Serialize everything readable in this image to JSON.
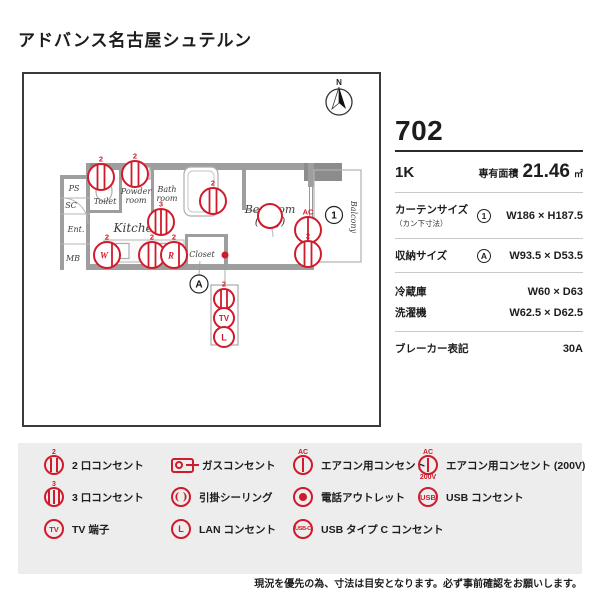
{
  "title": "アドバンス名古屋シュテルン",
  "colors": {
    "accent_red": "#cf1b2b",
    "wall_gray": "#9e9e9e"
  },
  "plan": {
    "north": "N",
    "rooms": {
      "ps": "PS",
      "sc": "SC",
      "ent": "Ent.",
      "mb": "MB",
      "toilet": "Toilet",
      "powder1": "Powder",
      "powder2": "room",
      "bath1": "Bath",
      "bath2": "room",
      "kitchen": "Kitchen",
      "bedroom1": "Bedroom",
      "bedroom2": "(6.0J)",
      "closet": "Closet",
      "balcony": "Balcony"
    },
    "markers": {
      "curtain": "1",
      "storage": "A"
    },
    "sym": {
      "sup2": "2",
      "sup3": "3",
      "ac": "AC",
      "w": "W",
      "r": "R",
      "tv": "TV",
      "lan": "L"
    }
  },
  "info": {
    "unit_number": "702",
    "layout": "1K",
    "area_label": "専有面積",
    "area_value": "21.46",
    "area_unit": "㎡",
    "rows": [
      {
        "label": "カーテンサイズ",
        "sublabel": "（カン下寸法）",
        "marker": "1",
        "value": "W186 × H187.5"
      },
      {
        "label": "収納サイズ",
        "marker": "A",
        "value": "W93.5 × D53.5"
      },
      {
        "label": "冷蔵庫",
        "value": "W60 × D63"
      },
      {
        "label": "洗濯機",
        "value": "W62.5 × D62.5"
      },
      {
        "label": "ブレーカー表記",
        "value": "30A"
      }
    ]
  },
  "legend": {
    "items": [
      {
        "type": "outlet2",
        "sup": "2",
        "label": "2 口コンセント"
      },
      {
        "type": "gas",
        "label": "ガスコンセント"
      },
      {
        "type": "outlet1",
        "sup": "AC",
        "label": "エアコン用コンセント"
      },
      {
        "type": "outlet1",
        "sup": "AC",
        "sub": "200V",
        "label": "エアコン用コンセント (200V)"
      },
      {
        "type": "outlet3",
        "sup": "3",
        "label": "3 口コンセント"
      },
      {
        "type": "ceiling",
        "icon_text": "(  )",
        "label": "引掛シーリング"
      },
      {
        "type": "phone",
        "label": "電話アウトレット"
      },
      {
        "type": "text",
        "icon_text": "USB",
        "label": "USB コンセント"
      },
      {
        "type": "text",
        "icon_text": "TV",
        "label": "TV 端子"
      },
      {
        "type": "text",
        "icon_text": "L",
        "label": "LAN コンセント"
      },
      {
        "type": "text",
        "icon_text": "USB-C",
        "label": "USB タイプ C コンセント"
      }
    ]
  },
  "disclaimer": "現況を優先の為、寸法は目安となります。必ず事前確認をお願いします。"
}
